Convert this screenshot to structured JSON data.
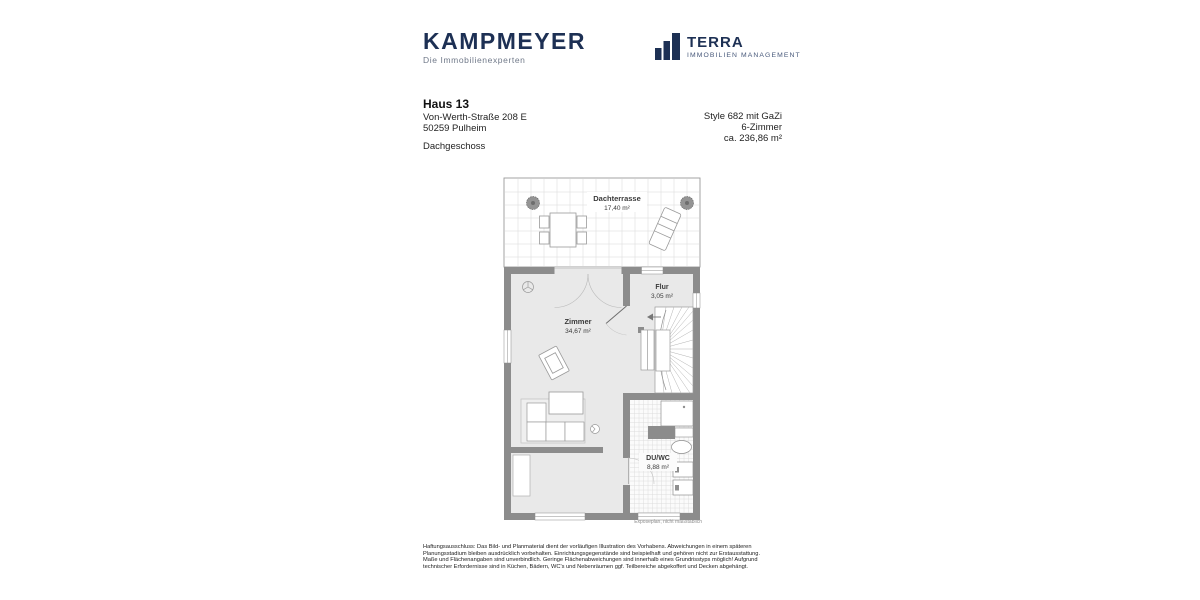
{
  "brand": {
    "kampmeyer_name": "KAMPMEYER",
    "kampmeyer_tagline": "Die Immobilienexperten",
    "terra_name": "TERRA",
    "terra_tagline": "IMMOBILIEN MANAGEMENT"
  },
  "title_block": {
    "house": "Haus 13",
    "street": "Von-Werth-Straße 208 E",
    "city": "50259 Pulheim",
    "floor": "Dachgeschoss"
  },
  "specs": {
    "style": "Style 682 mit GaZi",
    "rooms": "6-Zimmer",
    "area": "ca. 236,86 m²"
  },
  "floorplan": {
    "caption": "Exposeplan, nicht maßstäblich",
    "rooms": {
      "terrace": {
        "name": "Dachterrasse",
        "area": "17,40 m²"
      },
      "zimmer": {
        "name": "Zimmer",
        "area": "34,67 m²"
      },
      "flur": {
        "name": "Flur",
        "area": "3,05 m²"
      },
      "duwc": {
        "name": "DU/WC",
        "area": "8,88 m²"
      }
    }
  },
  "disclaimer": "Haftungsausschluss: Das Bild- und Planmaterial dient der vorläufigen Illustration des Vorhabens. Abweichungen in einem späteren Planungsstadium bleiben ausdrücklich vorbehalten. Einrichtungsgegenstände sind beispielhaft und gehören nicht zur Erstausstattung. Maße und Flächenangaben sind unverbindlich. Geringe Flächenabweichungen sind innerhalb eines Grundrisstyps möglich! Aufgrund technischer Erfordernisse sind in Küchen, Bädern, WC's und Nebenräumen ggf. Teilbereiche abgekoffert und Decken abgehängt.",
  "colors": {
    "brand_navy": "#1d3054",
    "wall_gray": "#8c8c8c",
    "floor_gray": "#e9e9e9",
    "tile_line": "#d7d7d7"
  }
}
